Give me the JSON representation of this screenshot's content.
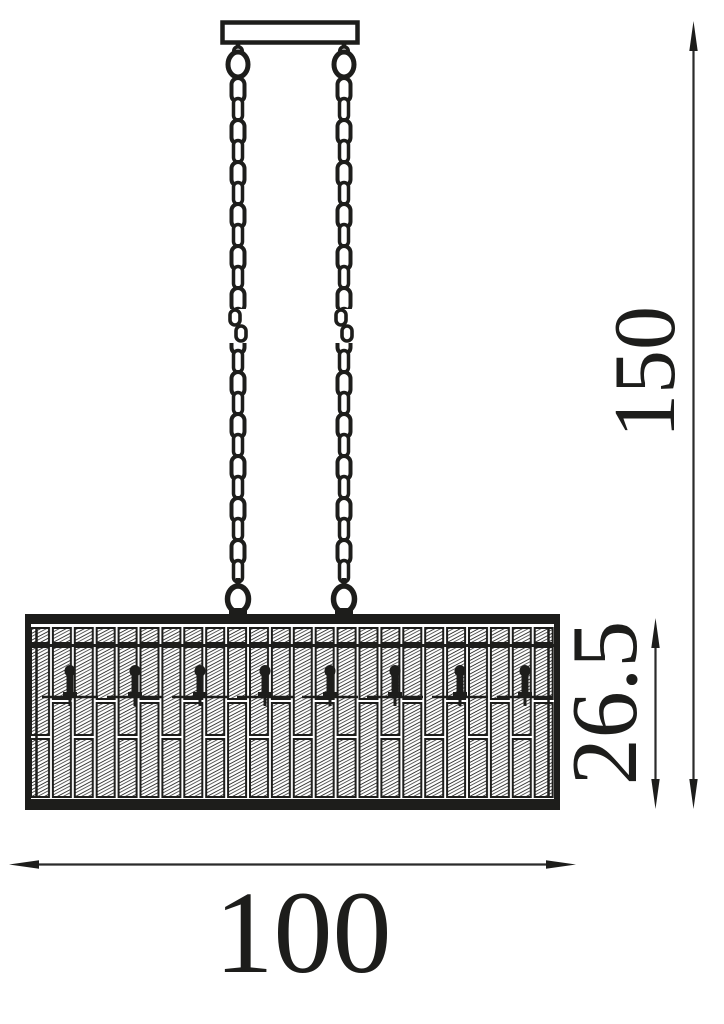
{
  "diagram": {
    "kind": "technical-dimension-drawing",
    "background_color": "#ffffff",
    "line_color": "#1d1d1b"
  },
  "dimensions": {
    "overall_height": "150",
    "shade_height": "26.5",
    "width": "100"
  }
}
